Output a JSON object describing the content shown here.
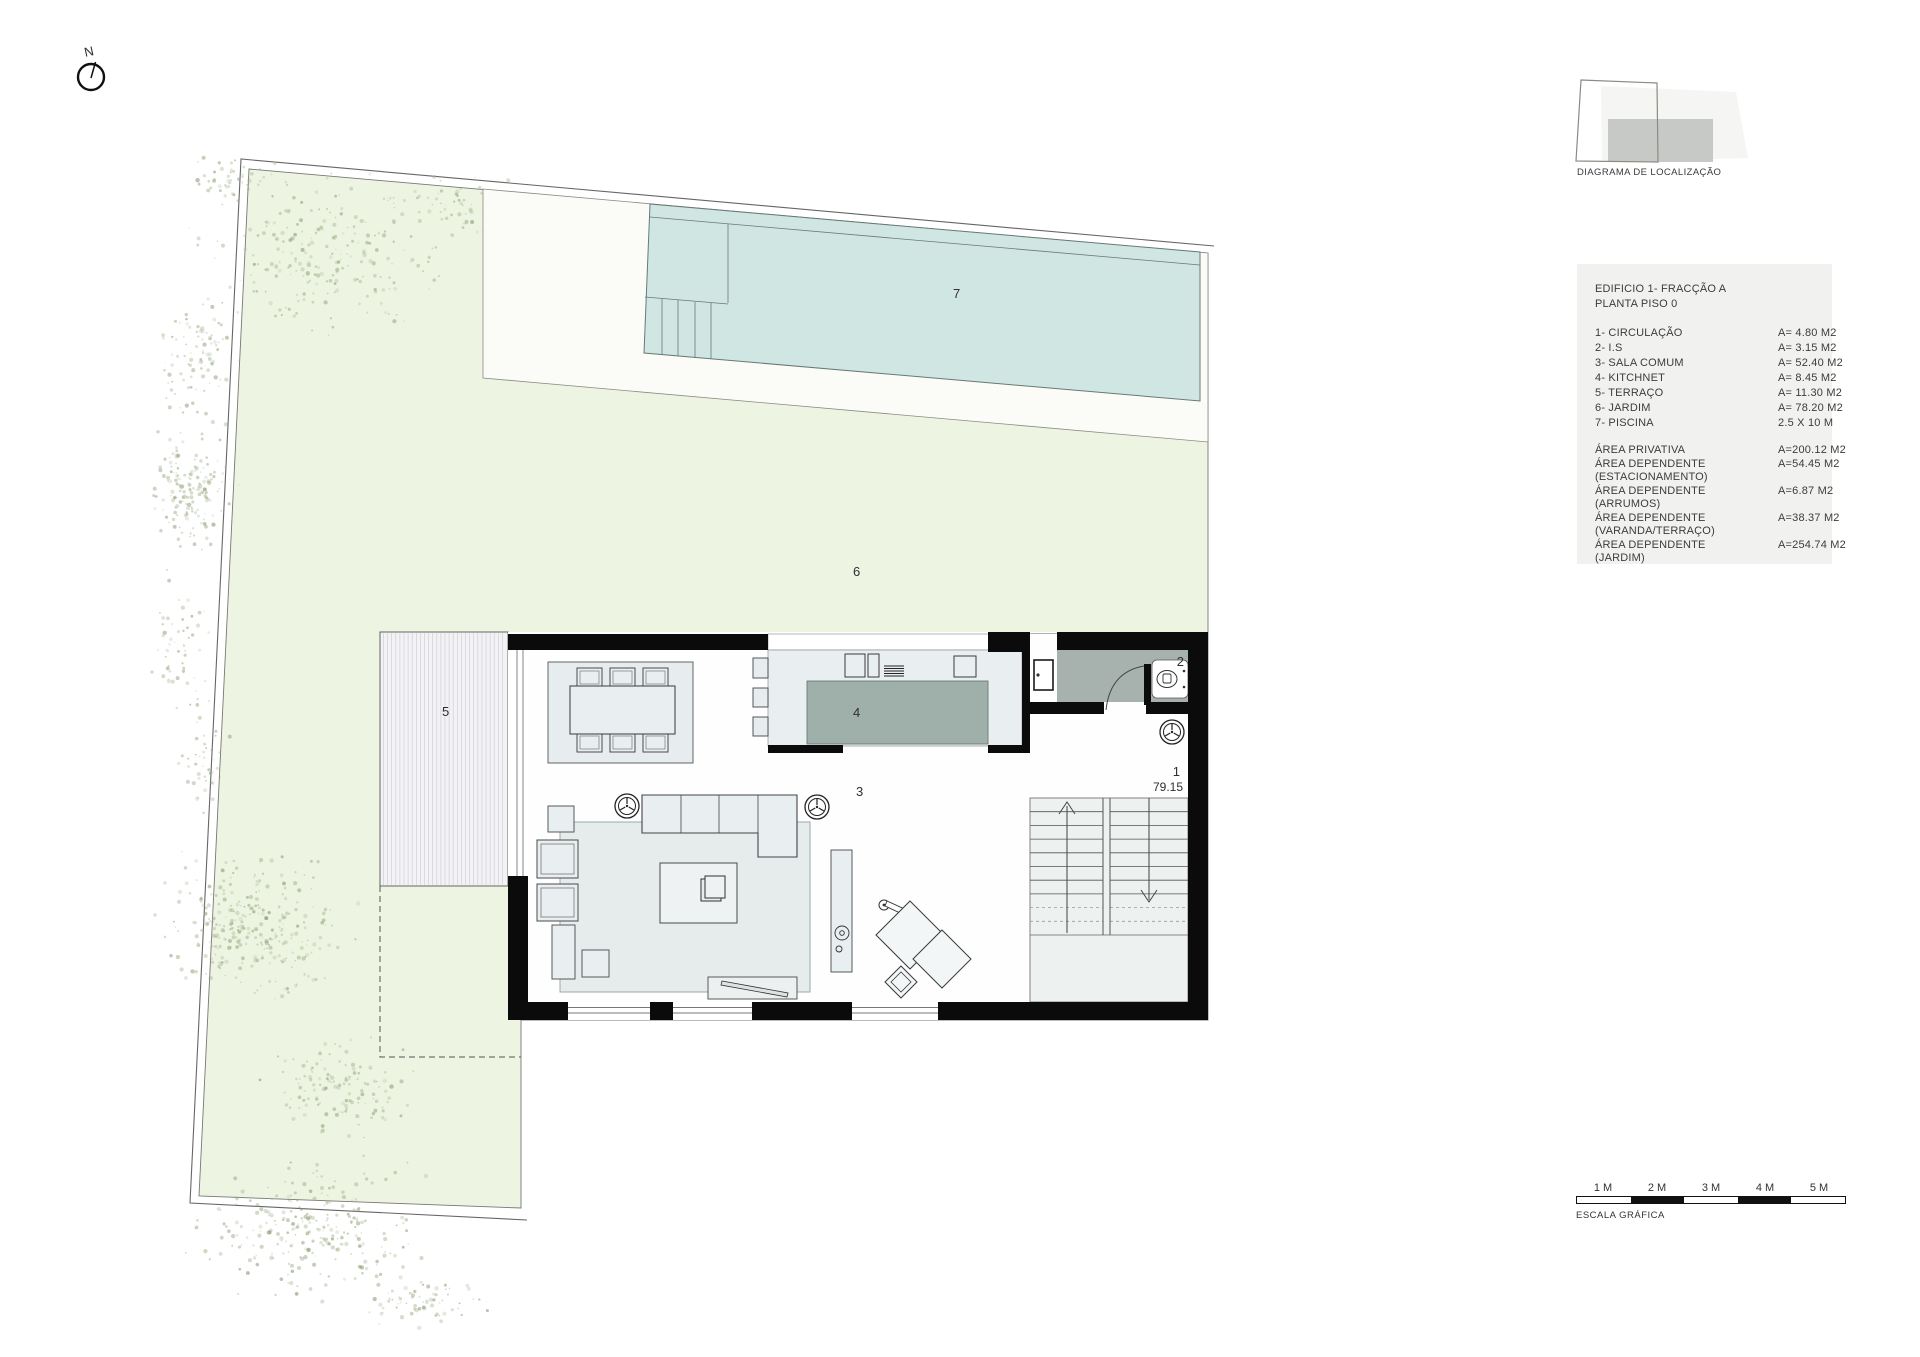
{
  "north_label": "N",
  "plan": {
    "labels": {
      "circulacao": "1",
      "is": "2",
      "sala": "3",
      "kitchnet": "4",
      "terraco": "5",
      "jardim": "6",
      "piscina": "7"
    },
    "level": "79.15"
  },
  "location_diagram": {
    "caption": "DIAGRAMA DE LOCALIZAÇÃO"
  },
  "legend": {
    "title_line1": "EDIFICIO 1- FRACÇÃO A",
    "title_line2": "PLANTA PISO 0",
    "items": [
      {
        "label": "1- CIRCULAÇÃO",
        "value": "A=  4.80 M2"
      },
      {
        "label": "2- I.S",
        "value": "A=  3.15 M2"
      },
      {
        "label": "3- SALA COMUM",
        "value": "A=  52.40 M2"
      },
      {
        "label": "4- KITCHNET",
        "value": "A=  8.45 M2"
      },
      {
        "label": "5- TERRAÇO",
        "value": "A=  11.30 M2"
      },
      {
        "label": "6- JARDIM",
        "value": "A=  78.20 M2"
      },
      {
        "label": "7- PISCINA",
        "value": "2.5 X 10 M"
      }
    ],
    "areas": [
      {
        "label": "ÁREA PRIVATIVA",
        "sublabel": "",
        "value": "A=200.12 M2"
      },
      {
        "label": "ÁREA DEPENDENTE",
        "sublabel": "(ESTACIONAMENTO)",
        "value": "A=54.45 M2"
      },
      {
        "label": "ÁREA DEPENDENTE",
        "sublabel": "(ARRUMOS)",
        "value": "A=6.87 M2"
      },
      {
        "label": "ÁREA DEPENDENTE",
        "sublabel": "(VARANDA/TERRAÇO)",
        "value": "A=38.37 M2"
      },
      {
        "label": "ÁREA DEPENDENTE",
        "sublabel": "(JARDIM)",
        "value": "A=254.74 M2"
      }
    ]
  },
  "scale_bar": {
    "labels": [
      "1 M",
      "2 M",
      "3 M",
      "4 M",
      "5 M"
    ],
    "caption": "ESCALA GRÁFICA"
  },
  "colors": {
    "garden": "#edf4e1",
    "pool": "#cfe6e2",
    "deck": "#fbfcf7",
    "wall": "#0b0b0b",
    "gray_unit": "#a2aeaa",
    "furniture": "#e9eef0"
  }
}
